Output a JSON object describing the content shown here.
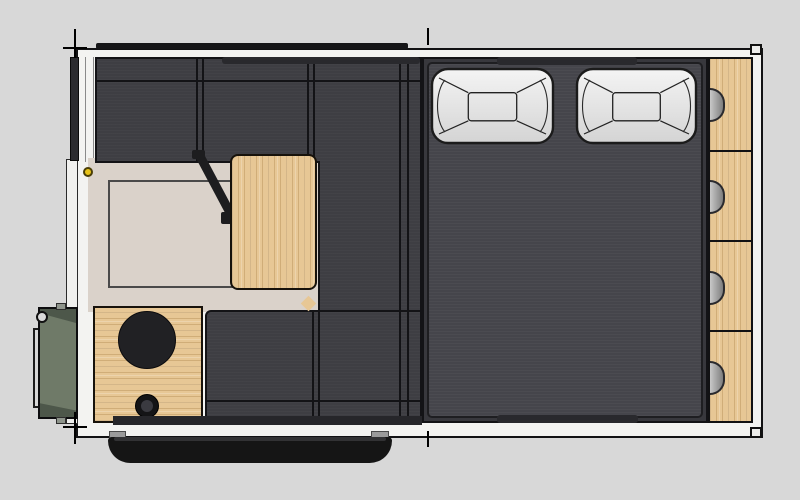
{
  "scene": {
    "type": "floor-plan-top-view",
    "subject": "truck-camper-interior-3d-plan"
  },
  "colors": {
    "background": "#d8d8d8",
    "shell": "#f3f3f1",
    "outline": "#121214",
    "cushion": "#3e3e43",
    "cushion_seam": "#131316",
    "mattress": "#45454b",
    "bed_frame": "#38383d",
    "pillow": "#f4f4f4",
    "pillow_shade": "#d4d4d4",
    "pillow_outline": "#1b1b1b",
    "wood": "#e7c795",
    "floor": "#dad2ca",
    "counter_circle": "#212124",
    "window_bar": "#29292d",
    "threshold": "#26262a",
    "exterior_box": "#6f7a68",
    "exterior_box_shade": "#4d574a",
    "bumper": "#151515",
    "bracket": "#9b9b9b",
    "knob": "#e7c319"
  },
  "bed": {
    "pillow_count": 2,
    "pillows": [
      {
        "x": 432,
        "y": 69,
        "w": 121,
        "h": 74
      },
      {
        "x": 577,
        "y": 69,
        "w": 119,
        "h": 74
      }
    ]
  },
  "cabinets": {
    "section_count": 4,
    "dividers": [
      92,
      182,
      272
    ],
    "handles": [
      46,
      138,
      229,
      319
    ]
  },
  "seating": {
    "top_bench_sections": 3,
    "bottom_bench_sections": 2
  },
  "kitchen": {
    "burner": {
      "cx": 147,
      "cy": 340,
      "r": 29
    },
    "drain": {
      "cx": 147,
      "cy": 406,
      "r": 12
    }
  }
}
